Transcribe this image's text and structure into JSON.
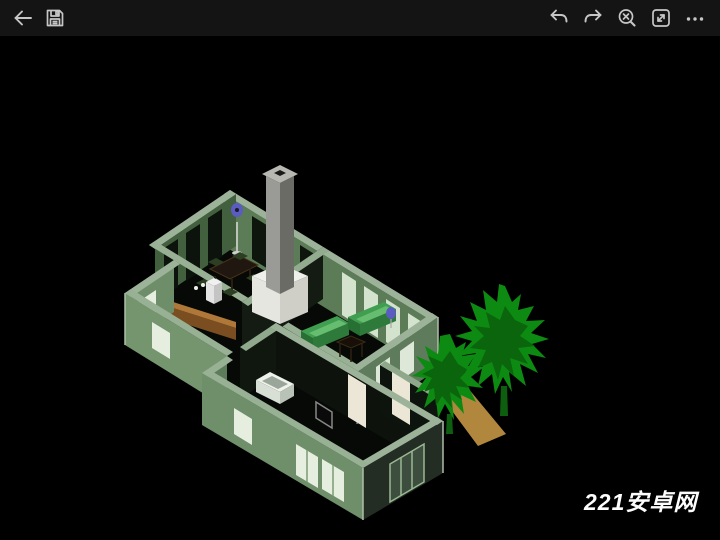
{
  "toolbar": {
    "background": "#141414",
    "icon_color": "#c6c6c6",
    "left_icons": [
      {
        "name": "back"
      },
      {
        "name": "save"
      }
    ],
    "right_icons": [
      {
        "name": "undo"
      },
      {
        "name": "redo"
      },
      {
        "name": "zoom-extents"
      },
      {
        "name": "fit-to-screen"
      },
      {
        "name": "more-options"
      }
    ]
  },
  "viewport": {
    "background": "#000000",
    "watermark": "221安卓网",
    "scene": {
      "model": "isometric-house-floorplan",
      "elements": [
        "house-walls",
        "chimney",
        "fireplace",
        "dining-table",
        "chairs",
        "floor-lamp",
        "kitchen-counter",
        "refrigerator",
        "sink",
        "sofas",
        "coffee-table",
        "side-table",
        "bathtub",
        "doors",
        "windows",
        "picture-frame",
        "wall-ornaments",
        "pine-trees",
        "walkway"
      ],
      "palette": {
        "wall_top": "#9cb399",
        "wall_light": "#7a9a74",
        "wall_medium": "#5e7b5c",
        "wall_inner": "#5c7c57",
        "wall_dark": "#232d23",
        "interior_dark": "#0d130d",
        "window_white": "#e6eee0",
        "window_dark_pane": "#3e4e3e",
        "chimney_light": "#9a9a96",
        "chimney_dark": "#6b6b66",
        "chimney_cap": "#b8b8b2",
        "fireplace_white": "#efefec",
        "sofa_green": "#3f9e50",
        "sofa_front": "#2e7a3a",
        "counter_brown": "#7a4e20",
        "counter_top": "#b07838",
        "tree_green": "#0d8a11",
        "tree_dark": "#0a650d",
        "path_tan": "#b1873e",
        "ornament_blue": "#5a5cc0",
        "door_white": "#ece6d6",
        "floor_black": "#060906"
      }
    }
  }
}
